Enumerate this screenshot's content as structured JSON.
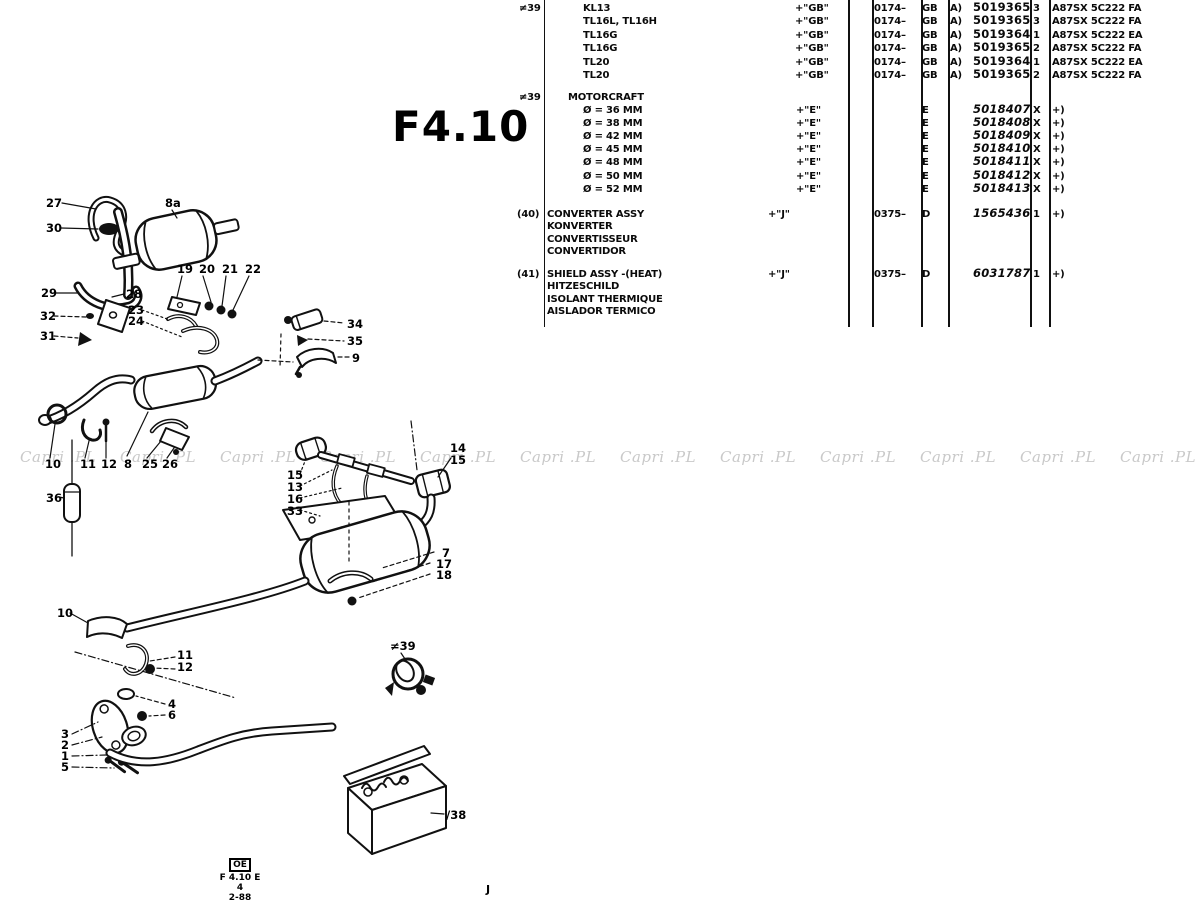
{
  "page": {
    "title": "F4.10",
    "footer_mark": "OE",
    "footer_code": "F 4.10 E 4",
    "footer_date": "2-88",
    "footer_letter": "J",
    "watermark_text": "Capri .PL",
    "ink_color": "#0a0a0a",
    "watermark_color": "#c9c9c9"
  },
  "diagram": {
    "callouts": [
      {
        "t": "27",
        "x": 46,
        "y": 207
      },
      {
        "t": "30",
        "x": 46,
        "y": 232
      },
      {
        "t": "8a",
        "x": 165,
        "y": 207
      },
      {
        "t": "29",
        "x": 41,
        "y": 297
      },
      {
        "t": "28",
        "x": 126,
        "y": 298
      },
      {
        "t": "32",
        "x": 40,
        "y": 320
      },
      {
        "t": "31",
        "x": 40,
        "y": 340
      },
      {
        "t": "23",
        "x": 128,
        "y": 314
      },
      {
        "t": "24",
        "x": 128,
        "y": 325
      },
      {
        "t": "19",
        "x": 177,
        "y": 273
      },
      {
        "t": "20",
        "x": 199,
        "y": 273
      },
      {
        "t": "21",
        "x": 222,
        "y": 273
      },
      {
        "t": "22",
        "x": 245,
        "y": 273
      },
      {
        "t": "34",
        "x": 347,
        "y": 328
      },
      {
        "t": "35",
        "x": 347,
        "y": 345
      },
      {
        "t": "9",
        "x": 352,
        "y": 362
      },
      {
        "t": "10",
        "x": 45,
        "y": 468
      },
      {
        "t": "11",
        "x": 80,
        "y": 468
      },
      {
        "t": "12",
        "x": 101,
        "y": 468
      },
      {
        "t": "8",
        "x": 124,
        "y": 468
      },
      {
        "t": "25",
        "x": 142,
        "y": 468
      },
      {
        "t": "26",
        "x": 162,
        "y": 468
      },
      {
        "t": "36",
        "x": 46,
        "y": 502
      },
      {
        "t": "15",
        "x": 287,
        "y": 479
      },
      {
        "t": "13",
        "x": 287,
        "y": 491
      },
      {
        "t": "16",
        "x": 287,
        "y": 503
      },
      {
        "t": "33",
        "x": 287,
        "y": 515
      },
      {
        "t": "14",
        "x": 450,
        "y": 452
      },
      {
        "t": "15",
        "x": 450,
        "y": 464
      },
      {
        "t": "7",
        "x": 442,
        "y": 557
      },
      {
        "t": "17",
        "x": 436,
        "y": 568
      },
      {
        "t": "18",
        "x": 436,
        "y": 579
      },
      {
        "t": "10",
        "x": 57,
        "y": 617
      },
      {
        "t": "11",
        "x": 177,
        "y": 659
      },
      {
        "t": "12",
        "x": 177,
        "y": 671
      },
      {
        "t": "4",
        "x": 168,
        "y": 708
      },
      {
        "t": "6",
        "x": 168,
        "y": 719
      },
      {
        "t": "3",
        "x": 61,
        "y": 738
      },
      {
        "t": "2",
        "x": 61,
        "y": 749
      },
      {
        "t": "1",
        "x": 61,
        "y": 760
      },
      {
        "t": "5",
        "x": 61,
        "y": 771
      },
      {
        "t": "≠39",
        "x": 390,
        "y": 650
      },
      {
        "t": "/38",
        "x": 446,
        "y": 819
      }
    ]
  },
  "table": {
    "sections": [
      {
        "callout": "≠39",
        "rows": [
          {
            "desc": "KL13",
            "code": "+\"GB\"",
            "date": "0174–",
            "market": "GB",
            "prefix": "A)",
            "part": "5019365",
            "qty": "3",
            "note": "A87SX 5C222 FA"
          },
          {
            "desc": "TL16L, TL16H",
            "code": "+\"GB\"",
            "date": "0174–",
            "market": "GB",
            "prefix": "A)",
            "part": "5019365",
            "qty": "3",
            "note": "A87SX 5C222 FA"
          },
          {
            "desc": "TL16G",
            "code": "+\"GB\"",
            "date": "0174–",
            "market": "GB",
            "prefix": "A)",
            "part": "5019364",
            "qty": "1",
            "note": "A87SX 5C222 EA"
          },
          {
            "desc": "TL16G",
            "code": "+\"GB\"",
            "date": "0174–",
            "market": "GB",
            "prefix": "A)",
            "part": "5019365",
            "qty": "2",
            "note": "A87SX 5C222 FA"
          },
          {
            "desc": "TL20",
            "code": "+\"GB\"",
            "date": "0174–",
            "market": "GB",
            "prefix": "A)",
            "part": "5019364",
            "qty": "1",
            "note": "A87SX 5C222 EA"
          },
          {
            "desc": "TL20",
            "code": "+\"GB\"",
            "date": "0174–",
            "market": "GB",
            "prefix": "A)",
            "part": "5019365",
            "qty": "2",
            "note": "A87SX 5C222 FA"
          }
        ]
      },
      {
        "callout": "≠39",
        "title": "MOTORCRAFT",
        "rows": [
          {
            "desc": "Ø = 36 MM",
            "code": "+\"E\"",
            "market": "E",
            "part": "5018407",
            "qty": "X",
            "note": "+)",
            "italic": true
          },
          {
            "desc": "Ø = 38 MM",
            "code": "+\"E\"",
            "market": "E",
            "part": "5018408",
            "qty": "X",
            "note": "+)",
            "italic": true
          },
          {
            "desc": "Ø = 42 MM",
            "code": "+\"E\"",
            "market": "E",
            "part": "5018409",
            "qty": "X",
            "note": "+)",
            "italic": true
          },
          {
            "desc": "Ø = 45 MM",
            "code": "+\"E\"",
            "market": "E",
            "part": "5018410",
            "qty": "X",
            "note": "+)",
            "italic": true
          },
          {
            "desc": "Ø = 48 MM",
            "code": "+\"E\"",
            "market": "E",
            "part": "5018411",
            "qty": "X",
            "note": "+)",
            "italic": true
          },
          {
            "desc": "Ø = 50 MM",
            "code": "+\"E\"",
            "market": "E",
            "part": "5018412",
            "qty": "X",
            "note": "+)",
            "italic": true
          },
          {
            "desc": "Ø = 52 MM",
            "code": "+\"E\"",
            "market": "E",
            "part": "5018413",
            "qty": "X",
            "note": "+)",
            "italic": true
          }
        ]
      },
      {
        "callout": "(40)",
        "desc_lines": [
          "CONVERTER ASSY",
          "KONVERTER",
          "CONVERTISSEUR",
          "CONVERTIDOR"
        ],
        "code": "+\"J\"",
        "date": "0375–",
        "market": "D",
        "part": "1565436",
        "qty": "1",
        "note": "+)",
        "italic": true
      },
      {
        "callout": "(41)",
        "desc_lines": [
          "SHIELD ASSY -(HEAT)",
          "HITZESCHILD",
          "ISOLANT THERMIQUE",
          "AISLADOR TERMICO"
        ],
        "code": "+\"J\"",
        "date": "0375–",
        "market": "D",
        "part": "6031787",
        "qty": "1",
        "note": "+)",
        "italic": true
      }
    ]
  }
}
